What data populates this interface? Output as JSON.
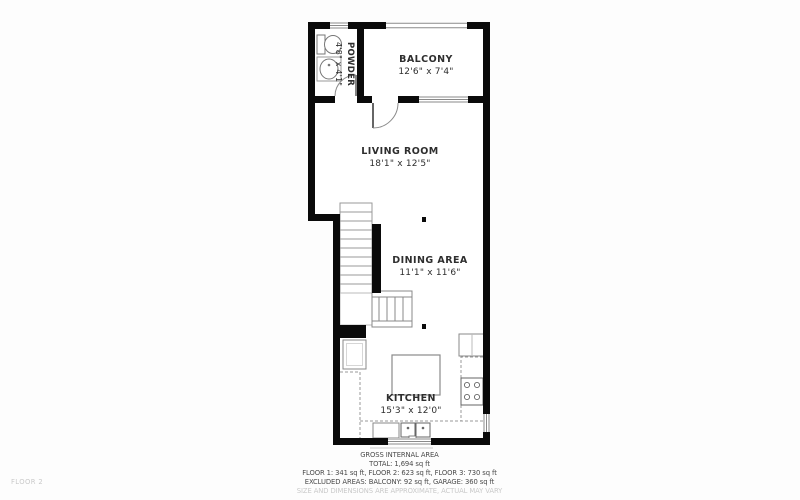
{
  "page": {
    "floor_label": "FLOOR 2"
  },
  "rooms": {
    "powder": {
      "name": "POWDER",
      "dims": "4'8\" x 4'1\""
    },
    "balcony": {
      "name": "BALCONY",
      "dims": "12'6\" x 7'4\""
    },
    "living": {
      "name": "LIVING ROOM",
      "dims": "18'1\" x 12'5\""
    },
    "dining": {
      "name": "DINING AREA",
      "dims": "11'1\" x 11'6\""
    },
    "kitchen": {
      "name": "KITCHEN",
      "dims": "15'3\" x 12'0\""
    }
  },
  "footer": {
    "title": "GROSS INTERNAL AREA",
    "total": "TOTAL: 1,694 sq ft",
    "floor_breakdown": "FLOOR 1: 341 sq ft, FLOOR 2: 623 sq ft, FLOOR 3: 730 sq ft",
    "excluded": "EXCLUDED AREAS: BALCONY: 92 sq ft, GARAGE: 360 sq ft",
    "disclaimer": "SIZE AND DIMENSIONS ARE APPROXIMATE, ACTUAL MAY VARY"
  },
  "colors": {
    "wall": "#0a0a0a",
    "fixture_line": "#8a8a8a",
    "label_text": "#2e2e2e",
    "muted_text": "#c9c9c9",
    "background": "#fdfdfd"
  }
}
